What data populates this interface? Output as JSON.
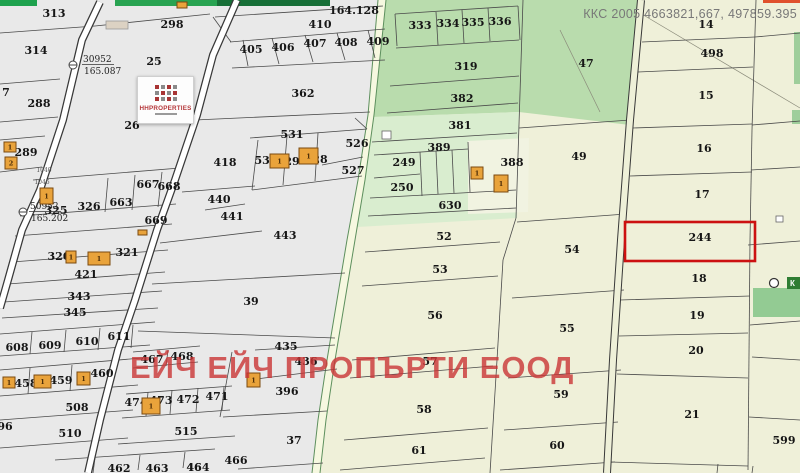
{
  "header": {
    "coords_label": "ККС 2005 4663821,667, 497859.395"
  },
  "watermark": {
    "text": "ЕЙЧ ЕЙЧ ПРОПЪРТИ ЕООД",
    "color": "#c93535"
  },
  "logo": {
    "title": "HHPROPERTIES",
    "accent": "#b5373a"
  },
  "map": {
    "width": 800,
    "height": 473,
    "palette": {
      "bg": "#eff0d9",
      "gray": "#e9e9e9",
      "green_med": "#b9dcad",
      "green_light": "#d9edcf",
      "cream_pocket": "#f1f3e1",
      "strip": "#f6f8e0",
      "line": "#4a4a4a",
      "green_line": "#5d8f5d",
      "road_casing": "#383838",
      "road_fill": "#ffffff",
      "right_road_fill": "#eef0d8",
      "red": "#cc1111",
      "building": "#e9a33b",
      "building_line": "#7a4a10",
      "beige": "#dcd2c3",
      "chip_green": "#2f7d33",
      "hatch_green": "#93cb93",
      "top_greens": [
        "#1ea24e",
        "#28a351",
        "#176f37"
      ],
      "red_sliver": "#e0512d",
      "edge_green": "#9fce9b"
    },
    "zones": {
      "gray_poly": "0,0 378,0 368,115 358,180 347,240 337,300 327,360 318,420 312,473 0,473",
      "strip_poly": "378,0 368,115 358,180 347,240 337,300 327,360 318,420 312,473 320,473 326,420 335,360 345,300 355,240 365,180 374,115 386,0",
      "strip_left": "378,0 368,115 358,180 347,240 337,300 327,360 318,420 312,473",
      "strip_right": "386,0 374,115 365,180 355,240 345,300 335,360 326,420 320,473",
      "green_med_poly": "386,0 523,0 519,112 373,117",
      "green_light_poly": "373,117 519,112 517,218 357,227",
      "pocket_poly": "468,141 529,138 528,212 468,214",
      "p47_poly": "523,0 642,0 630,125 519,112"
    },
    "misc_rects": [
      [
        0,
        0,
        37,
        6,
        "top_greens.0"
      ],
      [
        115,
        0,
        102,
        6,
        "top_greens.1"
      ],
      [
        217,
        0,
        113,
        6,
        "top_greens.2"
      ],
      [
        763,
        0,
        37,
        3,
        "red_sliver"
      ],
      [
        794,
        32,
        6,
        52,
        "edge_green"
      ],
      [
        792,
        110,
        8,
        14,
        "edge_green"
      ],
      [
        753,
        288,
        47,
        29,
        "hatch_green"
      ]
    ],
    "roads": {
      "road1": "100,2 82,40 63,120 40,190 22,230 8,280 0,308",
      "road2": "237,0 213,55 197,115 175,180 157,230 135,300 118,350 100,420 88,473",
      "right_road": "641,0 630,120 621,240 613,360 607,473"
    },
    "diagonals": [
      [
        640,
        13,
        800,
        108
      ],
      [
        560,
        30,
        600,
        112
      ]
    ],
    "lines": [
      [
        0,
        33,
        95,
        26
      ],
      [
        95,
        26,
        210,
        14
      ],
      [
        213,
        17,
        231,
        42
      ],
      [
        215,
        17,
        383,
        6
      ],
      [
        230,
        42,
        385,
        29
      ],
      [
        232,
        68,
        385,
        60
      ],
      [
        243,
        40,
        248,
        66
      ],
      [
        272,
        38,
        279,
        64
      ],
      [
        305,
        35,
        313,
        62
      ],
      [
        337,
        33,
        345,
        60
      ],
      [
        368,
        30,
        375,
        58
      ],
      [
        195,
        120,
        370,
        112
      ],
      [
        250,
        138,
        367,
        129
      ],
      [
        258,
        140,
        252,
        190
      ],
      [
        252,
        190,
        362,
        176
      ],
      [
        287,
        136,
        283,
        185
      ],
      [
        318,
        133,
        315,
        181
      ],
      [
        322,
        165,
        363,
        157
      ],
      [
        355,
        118,
        367,
        129
      ],
      [
        182,
        192,
        255,
        186
      ],
      [
        205,
        210,
        245,
        204
      ],
      [
        160,
        243,
        262,
        231
      ],
      [
        152,
        284,
        345,
        273
      ],
      [
        138,
        331,
        335,
        338
      ],
      [
        255,
        350,
        335,
        345
      ],
      [
        256,
        379,
        337,
        369
      ],
      [
        223,
        417,
        327,
        411
      ],
      [
        238,
        469,
        323,
        463
      ],
      [
        232,
        352,
        220,
        417
      ],
      [
        0,
        84,
        60,
        79
      ],
      [
        0,
        122,
        58,
        117
      ],
      [
        0,
        140,
        45,
        136
      ],
      [
        0,
        172,
        42,
        167
      ],
      [
        33,
        180,
        180,
        168
      ],
      [
        108,
        178,
        105,
        212
      ],
      [
        135,
        175,
        132,
        210
      ],
      [
        162,
        172,
        158,
        207
      ],
      [
        20,
        216,
        176,
        204
      ],
      [
        15,
        236,
        172,
        224
      ],
      [
        12,
        262,
        168,
        250
      ],
      [
        8,
        284,
        165,
        272
      ],
      [
        4,
        302,
        162,
        291
      ],
      [
        2,
        318,
        158,
        308
      ],
      [
        0,
        334,
        155,
        322
      ],
      [
        0,
        356,
        150,
        345
      ],
      [
        32,
        332,
        30,
        354
      ],
      [
        66,
        330,
        64,
        352
      ],
      [
        100,
        328,
        98,
        350
      ],
      [
        133,
        325,
        131,
        348
      ],
      [
        0,
        370,
        142,
        358
      ],
      [
        0,
        396,
        138,
        385
      ],
      [
        30,
        368,
        28,
        394
      ],
      [
        72,
        365,
        70,
        391
      ],
      [
        112,
        362,
        110,
        389
      ],
      [
        0,
        420,
        133,
        410
      ],
      [
        0,
        448,
        128,
        438
      ],
      [
        55,
        460,
        215,
        449
      ],
      [
        95,
        458,
        93,
        473
      ],
      [
        140,
        455,
        138,
        470
      ],
      [
        185,
        452,
        183,
        468
      ],
      [
        133,
        352,
        200,
        346
      ],
      [
        133,
        368,
        198,
        362
      ],
      [
        168,
        350,
        166,
        366
      ],
      [
        126,
        394,
        232,
        386
      ],
      [
        122,
        418,
        230,
        410
      ],
      [
        148,
        392,
        146,
        416
      ],
      [
        172,
        390,
        170,
        414
      ],
      [
        198,
        388,
        196,
        412
      ],
      [
        224,
        387,
        222,
        410
      ],
      [
        118,
        444,
        235,
        436
      ],
      [
        395,
        14,
        518,
        6
      ],
      [
        396,
        48,
        519,
        40
      ],
      [
        436,
        12,
        438,
        45
      ],
      [
        462,
        10,
        464,
        43
      ],
      [
        488,
        8,
        490,
        41
      ],
      [
        395,
        14,
        397,
        46
      ],
      [
        518,
        6,
        520,
        40
      ],
      [
        390,
        86,
        519,
        76
      ],
      [
        387,
        113,
        518,
        103
      ],
      [
        523,
        0,
        516,
        218
      ],
      [
        372,
        142,
        517,
        133
      ],
      [
        374,
        155,
        468,
        149
      ],
      [
        370,
        198,
        516,
        190
      ],
      [
        420,
        152,
        422,
        196
      ],
      [
        436,
        151,
        438,
        194
      ],
      [
        452,
        150,
        454,
        193
      ],
      [
        468,
        142,
        470,
        192
      ],
      [
        374,
        178,
        420,
        174
      ],
      [
        368,
        216,
        516,
        208
      ],
      [
        365,
        252,
        500,
        242
      ],
      [
        362,
        286,
        498,
        276
      ],
      [
        352,
        360,
        495,
        348
      ],
      [
        350,
        378,
        493,
        366
      ],
      [
        344,
        440,
        488,
        428
      ],
      [
        340,
        470,
        485,
        458
      ],
      [
        519,
        128,
        630,
        120
      ],
      [
        517,
        222,
        626,
        214
      ],
      [
        512,
        298,
        624,
        290
      ],
      [
        508,
        378,
        621,
        370
      ],
      [
        504,
        430,
        618,
        422
      ],
      [
        500,
        470,
        615,
        462
      ],
      [
        516,
        218,
        503,
        260
      ],
      [
        503,
        260,
        497,
        360
      ],
      [
        497,
        360,
        490,
        473
      ],
      [
        642,
        42,
        755,
        37
      ],
      [
        638,
        72,
        753,
        67
      ],
      [
        633,
        128,
        752,
        124
      ],
      [
        630,
        176,
        752,
        172
      ],
      [
        620,
        300,
        750,
        296
      ],
      [
        619,
        336,
        748,
        333
      ],
      [
        617,
        374,
        748,
        378
      ],
      [
        610,
        462,
        748,
        466
      ],
      [
        756,
        0,
        752,
        130
      ],
      [
        752,
        130,
        750,
        240
      ],
      [
        750,
        240,
        748,
        470
      ],
      [
        755,
        37,
        800,
        33
      ],
      [
        752,
        125,
        800,
        121
      ],
      [
        751,
        170,
        800,
        167
      ],
      [
        748,
        245,
        800,
        241
      ],
      [
        750,
        325,
        800,
        321
      ],
      [
        752,
        357,
        800,
        360
      ],
      [
        749,
        417,
        800,
        420
      ],
      [
        718,
        464,
        717,
        473
      ],
      [
        753,
        466,
        752,
        473
      ]
    ],
    "labels": [
      [
        "313",
        54,
        17
      ],
      [
        "314",
        36,
        54
      ],
      [
        "298",
        172,
        28
      ],
      [
        "25",
        154,
        65
      ],
      [
        "288",
        39,
        107
      ],
      [
        "7",
        6,
        96
      ],
      [
        "26",
        132,
        129
      ],
      [
        "289",
        26,
        156
      ],
      [
        "164.128",
        354,
        14
      ],
      [
        "410",
        320,
        28
      ],
      [
        "405",
        251,
        53
      ],
      [
        "406",
        283,
        51
      ],
      [
        "407",
        315,
        47
      ],
      [
        "408",
        346,
        46
      ],
      [
        "409",
        378,
        45
      ],
      [
        "362",
        303,
        97
      ],
      [
        "531",
        292,
        138
      ],
      [
        "526",
        357,
        147
      ],
      [
        "418",
        225,
        166
      ],
      [
        "530",
        266,
        164
      ],
      [
        "29",
        292,
        165
      ],
      [
        "28",
        320,
        163
      ],
      [
        "527",
        353,
        174
      ],
      [
        "440",
        219,
        203
      ],
      [
        "441",
        232,
        220
      ],
      [
        "443",
        285,
        239
      ],
      [
        "667",
        148,
        188
      ],
      [
        "668",
        169,
        190
      ],
      [
        "663",
        121,
        206
      ],
      [
        "326",
        89,
        210
      ],
      [
        "325",
        56,
        214
      ],
      [
        "669",
        156,
        224
      ],
      [
        "320",
        59,
        260
      ],
      [
        "321",
        127,
        256
      ],
      [
        "421",
        86,
        278
      ],
      [
        "343",
        79,
        300
      ],
      [
        "345",
        75,
        316
      ],
      [
        "39",
        251,
        305
      ],
      [
        "611",
        119,
        340
      ],
      [
        "610",
        87,
        345
      ],
      [
        "609",
        50,
        349
      ],
      [
        "608",
        17,
        351
      ],
      [
        "467",
        152,
        363
      ],
      [
        "468",
        182,
        360
      ],
      [
        "458",
        26,
        387
      ],
      [
        "459",
        61,
        384
      ],
      [
        "460",
        102,
        377
      ],
      [
        "508",
        77,
        411
      ],
      [
        "474",
        136,
        406
      ],
      [
        "473",
        161,
        404
      ],
      [
        "472",
        188,
        403
      ],
      [
        "471",
        217,
        400
      ],
      [
        "436",
        306,
        365
      ],
      [
        "396",
        287,
        395
      ],
      [
        "435",
        286,
        350
      ],
      [
        "510",
        70,
        437
      ],
      [
        "515",
        186,
        435
      ],
      [
        "96",
        5,
        430
      ],
      [
        "37",
        294,
        444
      ],
      [
        "466",
        236,
        464
      ],
      [
        "464",
        198,
        471
      ],
      [
        "462",
        119,
        472
      ],
      [
        "463",
        157,
        472
      ],
      [
        "46",
        194,
        471
      ],
      [
        "333",
        420,
        29
      ],
      [
        "334",
        448,
        27
      ],
      [
        "335",
        473,
        26
      ],
      [
        "336",
        500,
        25
      ],
      [
        "319",
        466,
        70
      ],
      [
        "382",
        462,
        102
      ],
      [
        "47",
        586,
        67
      ],
      [
        "381",
        460,
        129
      ],
      [
        "389",
        439,
        151
      ],
      [
        "249",
        404,
        166
      ],
      [
        "250",
        402,
        191
      ],
      [
        "630",
        450,
        209
      ],
      [
        "388",
        512,
        166
      ],
      [
        "49",
        579,
        160
      ],
      [
        "52",
        444,
        240
      ],
      [
        "53",
        440,
        273
      ],
      [
        "56",
        435,
        319
      ],
      [
        "57",
        430,
        365
      ],
      [
        "58",
        424,
        413
      ],
      [
        "61",
        419,
        454
      ],
      [
        "54",
        572,
        253
      ],
      [
        "55",
        567,
        332
      ],
      [
        "59",
        561,
        398
      ],
      [
        "60",
        557,
        449
      ],
      [
        "14",
        706,
        28
      ],
      [
        "498",
        712,
        57
      ],
      [
        "15",
        706,
        99
      ],
      [
        "16",
        704,
        152
      ],
      [
        "17",
        702,
        198
      ],
      [
        "18",
        699,
        282
      ],
      [
        "19",
        697,
        319
      ],
      [
        "20",
        696,
        354
      ],
      [
        "21",
        692,
        418
      ],
      [
        "599",
        784,
        444
      ]
    ],
    "road_labels": [
      [
        "1040",
        44,
        172
      ],
      [
        "1046",
        42,
        184
      ]
    ],
    "survey_points": [
      {
        "number": "30952",
        "elevation": "165.087",
        "cx": 73,
        "cy": 65,
        "tx": 83,
        "ty": 62
      },
      {
        "number": "50952",
        "elevation": "165.202",
        "cx": 23,
        "cy": 212,
        "tx": 30,
        "ty": 209
      }
    ],
    "white_boxes": [
      [
        382,
        131,
        9,
        8
      ],
      [
        776,
        216,
        7,
        6
      ]
    ],
    "marker_circle": {
      "cx": 774,
      "cy": 283,
      "r": 4.5
    },
    "legend_chip": {
      "x": 787,
      "y": 277,
      "w": 13,
      "h": 12,
      "text": "К"
    },
    "highlight": {
      "label": "244",
      "x": 625,
      "y": 222,
      "w": 130,
      "h": 39,
      "lx": 700,
      "ly": 241
    },
    "beige_building": [
      106,
      21,
      22,
      8
    ],
    "buildings": [
      [
        177,
        2,
        10,
        6,
        ""
      ],
      [
        4,
        142,
        12,
        10,
        "1"
      ],
      [
        5,
        157,
        12,
        12,
        "2"
      ],
      [
        40,
        188,
        13,
        16,
        "1"
      ],
      [
        270,
        154,
        19,
        14,
        "1"
      ],
      [
        299,
        148,
        19,
        16,
        "1"
      ],
      [
        471,
        167,
        12,
        12,
        "1"
      ],
      [
        494,
        175,
        14,
        17,
        "1"
      ],
      [
        138,
        230,
        9,
        5,
        ""
      ],
      [
        66,
        251,
        10,
        12,
        "1"
      ],
      [
        88,
        252,
        22,
        13,
        "1"
      ],
      [
        3,
        377,
        12,
        11,
        "1"
      ],
      [
        34,
        375,
        17,
        13,
        "1"
      ],
      [
        77,
        372,
        13,
        13,
        "1"
      ],
      [
        142,
        398,
        18,
        16,
        "1"
      ],
      [
        247,
        373,
        13,
        14,
        "1"
      ]
    ]
  }
}
